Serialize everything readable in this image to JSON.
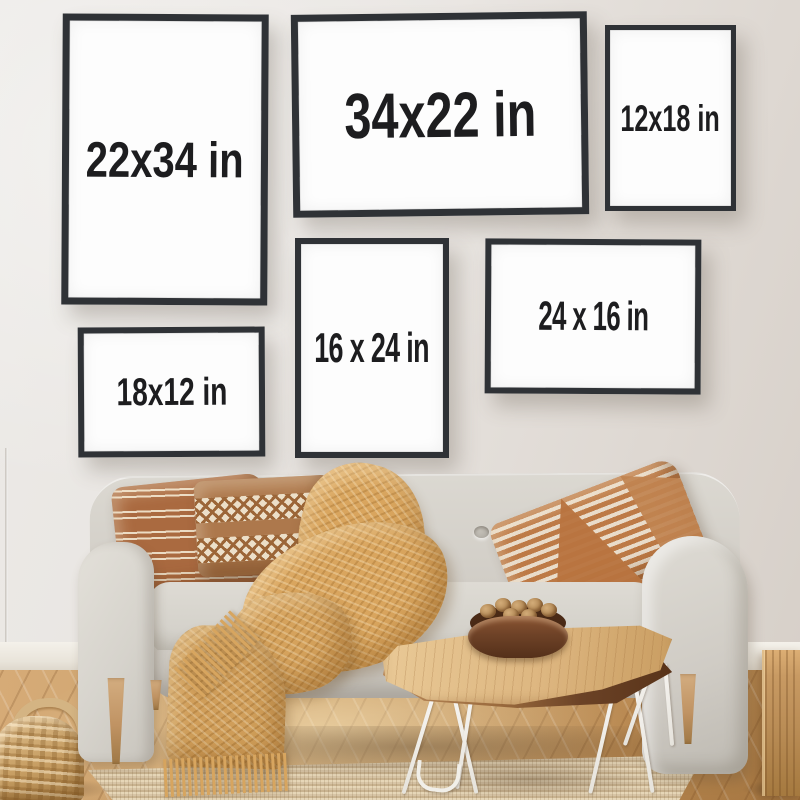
{
  "scene": {
    "alt": "Living room photo mockup: six black poster frames on a wall, each labeled with its print size, above a light beige sofa with terracotta pillows and a mustard throw blanket, a live-edge coffee table with a wooden bowl of walnuts on hairpin legs, a jute rug, a woven basket and a wooden cube stool on herringbone parquet"
  },
  "frames": [
    {
      "id": "22x34",
      "label": "22x34 in",
      "orientation": "portrait"
    },
    {
      "id": "34x22",
      "label": "34x22 in",
      "orientation": "landscape"
    },
    {
      "id": "12x18",
      "label": "12x18 in",
      "orientation": "portrait"
    },
    {
      "id": "18x12",
      "label": "18x12 in",
      "orientation": "landscape"
    },
    {
      "id": "16x24",
      "label": "16 x 24 in",
      "orientation": "portrait"
    },
    {
      "id": "24x16",
      "label": "24 x 16 in",
      "orientation": "landscape"
    }
  ],
  "colors": {
    "wall": "#e8e4e0",
    "frame_border": "#2f3236",
    "frame_mat": "#fdfdfd",
    "label_text": "#1d1d1f",
    "sofa_fabric": "#d6d2ca",
    "pillow_terracotta": "#a96b41",
    "pillow_cream": "#ecdcc4",
    "blanket_mustard": "#d9a55e",
    "floor_wood": "#cda169",
    "rug_jute": "#d8c5a6",
    "table_wood": "#ddb680",
    "table_edge_walnut": "#5f3a1f",
    "hairpin_white": "#f3f1ed",
    "bowl_brown": "#6e4227",
    "basket_tan": "#c79e63",
    "cube_oak": "#c2945e",
    "sofa_leg_wood": "#c09363"
  }
}
